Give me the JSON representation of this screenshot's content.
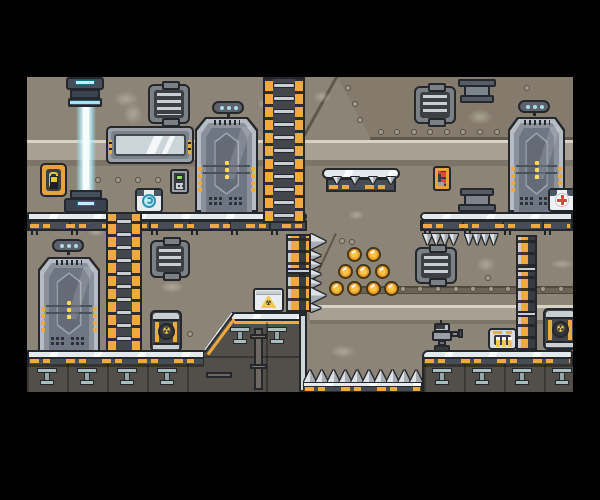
{
  "app": {
    "type": "game-screenshot",
    "genre": "sci-fi platformer level (no HUD, no text)",
    "window": {
      "width": 600,
      "height": 500
    },
    "viewport": {
      "x": 27,
      "y": 77,
      "width": 546,
      "height": 315
    }
  },
  "palette": {
    "frame": "#000000",
    "wall": "#8c8476",
    "wall_panel": "#847b6d",
    "light_band": "#a8a193",
    "band_highlight": "#d8d3c7",
    "band_shadow": "#7c7466",
    "metal_light": "#e3eaed",
    "metal_dark": "#474d55",
    "hazard_yellow": "#f0a93c",
    "outline": "#24272b",
    "rock": "#524e49",
    "coin_outer": "#f09d27",
    "coin_inner": "#f8c648",
    "beam_cyan": "#bfeefc",
    "glass": "#ccd5da",
    "sign_dot_cyan": "#a8dcec",
    "alert_red": "#d84b40",
    "uranium_yellow": "#f2c94c",
    "keypad_green": "#8edc62"
  },
  "symbols": {
    "radiation": "☢"
  },
  "level": {
    "objects": [
      {
        "name": "teleporter-emitter"
      },
      {
        "name": "energy-beam"
      },
      {
        "name": "teleporter-base"
      },
      {
        "name": "door",
        "count": 3
      },
      {
        "name": "door-sign",
        "count": 3
      },
      {
        "name": "ladder",
        "count": 2
      },
      {
        "name": "air-vent",
        "count": 4
      },
      {
        "name": "window"
      },
      {
        "name": "wall-switch"
      },
      {
        "name": "keypad"
      },
      {
        "name": "control-panel-red"
      },
      {
        "name": "battery-charger"
      },
      {
        "name": "medkit"
      },
      {
        "name": "pipe-machine",
        "count": 2
      },
      {
        "name": "hazard-crate"
      },
      {
        "name": "radioactive-barrel",
        "count": 2
      },
      {
        "name": "robot"
      },
      {
        "name": "dispenser-console"
      },
      {
        "name": "coin",
        "count": 9
      },
      {
        "name": "spike-trap-floor"
      },
      {
        "name": "spike-trap-wall"
      },
      {
        "name": "spike-trap-ceiling",
        "count": 2
      },
      {
        "name": "hazard-column",
        "count": 2
      },
      {
        "name": "floating-platform"
      }
    ],
    "coins": [
      [
        327,
        177
      ],
      [
        346,
        177
      ],
      [
        318,
        194
      ],
      [
        336,
        194
      ],
      [
        355,
        194
      ],
      [
        309,
        211
      ],
      [
        327,
        211
      ],
      [
        346,
        211
      ],
      [
        364,
        211
      ]
    ],
    "rivets": [
      [
        354,
        55
      ],
      [
        370,
        55
      ],
      [
        387,
        55
      ],
      [
        403,
        55
      ],
      [
        420,
        55
      ],
      [
        436,
        55
      ],
      [
        453,
        55
      ],
      [
        470,
        55
      ],
      [
        321,
        11
      ],
      [
        328,
        27
      ],
      [
        333,
        43
      ],
      [
        500,
        11
      ],
      [
        71,
        103
      ],
      [
        91,
        103
      ],
      [
        111,
        103
      ],
      [
        131,
        103
      ],
      [
        315,
        164
      ],
      [
        325,
        165
      ],
      [
        376,
        212
      ],
      [
        393,
        212
      ],
      [
        411,
        212
      ],
      [
        429,
        212
      ],
      [
        446,
        212
      ],
      [
        464,
        212
      ],
      [
        481,
        212
      ],
      [
        499,
        212
      ],
      [
        516,
        212
      ],
      [
        534,
        212
      ],
      [
        163,
        257
      ],
      [
        461,
        201
      ]
    ],
    "spike_groups": [
      {
        "dir": "u",
        "x": 277,
        "y": 293,
        "w": 12,
        "h": 12,
        "n": 10,
        "dx": 11.8,
        "dy": 0
      },
      {
        "dir": "d",
        "x": 396,
        "y": 157,
        "w": 9,
        "h": 11,
        "n": 4,
        "dx": 8.7,
        "dy": 0
      },
      {
        "dir": "d",
        "x": 438,
        "y": 157,
        "w": 8,
        "h": 11,
        "n": 4,
        "dx": 8.2,
        "dy": 0
      },
      {
        "dir": "d",
        "x": 306,
        "y": 100,
        "w": 8,
        "h": 7,
        "n": 4,
        "dx": 18,
        "dy": 0
      },
      {
        "dir": "r",
        "x": 284,
        "y": 157,
        "w": 15,
        "h": 15,
        "n": 1,
        "dx": 0,
        "dy": 0
      },
      {
        "dir": "r",
        "x": 284,
        "y": 174,
        "w": 10,
        "h": 9,
        "n": 4,
        "dx": 0,
        "dy": 9.3
      },
      {
        "dir": "r",
        "x": 284,
        "y": 211,
        "w": 15,
        "h": 15,
        "n": 1,
        "dx": 0,
        "dy": 0
      },
      {
        "dir": "r",
        "x": 284,
        "y": 227,
        "w": 10,
        "h": 8,
        "n": 1,
        "dx": 0,
        "dy": 0
      }
    ],
    "ladder_rungs": [
      {
        "ladder": "ladder-1",
        "count": 11,
        "step": 13,
        "start": 4
      },
      {
        "ladder": "ladder-2",
        "count": 10,
        "step": 13,
        "start": 5
      }
    ],
    "t_supports": [
      {
        "x": 10,
        "y": 291,
        "parent": "scene"
      },
      {
        "x": 50,
        "y": 291,
        "parent": "scene"
      },
      {
        "x": 90,
        "y": 291,
        "parent": "scene"
      },
      {
        "x": 130,
        "y": 291,
        "parent": "scene"
      },
      {
        "x": 405,
        "y": 291,
        "parent": "scene"
      },
      {
        "x": 445,
        "y": 291,
        "parent": "scene"
      },
      {
        "x": 485,
        "y": 291,
        "parent": "scene"
      },
      {
        "x": 525,
        "y": 291,
        "parent": "scene"
      },
      {
        "x": 26,
        "y": 15,
        "parent": "block"
      },
      {
        "x": 63,
        "y": 15,
        "parent": "block"
      }
    ],
    "stains": [
      {
        "x": 86,
        "y": 14,
        "w": 26,
        "h": 16
      },
      {
        "x": 230,
        "y": 22,
        "w": 16,
        "h": 10
      },
      {
        "x": 286,
        "y": 14,
        "w": 18,
        "h": 12
      },
      {
        "x": 96,
        "y": 26,
        "w": 20,
        "h": 22
      },
      {
        "x": 440,
        "y": 32,
        "w": 26,
        "h": 16
      },
      {
        "x": 133,
        "y": 204,
        "w": 24,
        "h": 12
      },
      {
        "x": 321,
        "y": 133,
        "w": 17,
        "h": 10
      },
      {
        "x": 303,
        "y": 268,
        "w": 26,
        "h": 13
      },
      {
        "x": 449,
        "y": 180,
        "w": 20,
        "h": 15
      },
      {
        "x": 523,
        "y": 182,
        "w": 24,
        "h": 10
      },
      {
        "x": 60,
        "y": 150,
        "w": 18,
        "h": 10
      }
    ]
  }
}
